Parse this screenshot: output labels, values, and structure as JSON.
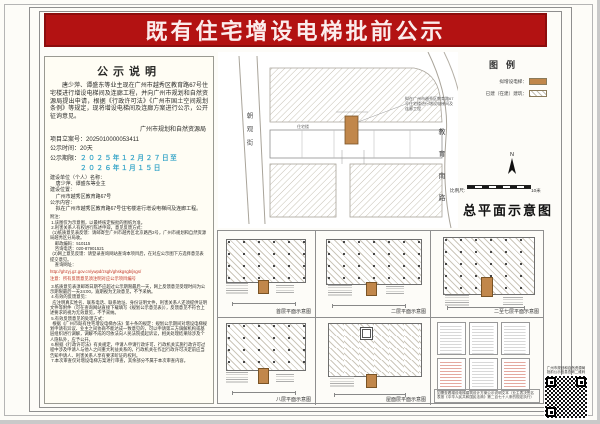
{
  "banner": {
    "title": "既有住宅增设电梯批前公示"
  },
  "notice": {
    "heading": "公示说明",
    "paragraph": "唐少萍、谭盛东等业主现在广州市越秀区教育路67号住宅楼进行增设电梯间及连廊工程，并向广州市规划和自然资源局提出申请，根据《行政许可法》《广州市国土空间规划条例》等规定，现将增设电梯间及连廊方案进行公示，公开征询意见。",
    "signature": "广州市规划和自然资源局",
    "case_no_label": "项目立案号：",
    "case_no": "2025010000053411",
    "duration_label": "公示时间：",
    "duration": "20天",
    "period_label": "公示期限：",
    "period_line1": "２０２５年１２月２７日至",
    "period_line2": "２０２６年１月１５日",
    "info_text": "建设单位（个人）名称：\n    唐少萍、谭盛东等业主\n建设位置：\n    广州市越秀区教育路67号\n公示内容：\n    拟在广州市越秀区教育路67号住宅楼进行增设电梯间及连廊工程。",
    "notes_part1": "附注：\n 1.该图仅为示意图，以最终核定报批的图纸为准。\n 2.利害关系人有权进行陈述申辩，意见反馈方式：\n  (1)纸质意见表反馈：请邮寄至广州市越秀区北京路西2号，广州市规划和自然资源局越秀区分局收。\n    邮政编码：510115\n    咨询电话：020-87901521\n  (2)网上意见反馈：请登录查询网站查询本项目后，在对应公示图下方选择意见表提交意见。\n    查询网址：",
    "notes_url": "http://ghzyj.gz.gov.cn/ywpd/zsgh/ghskgsgb/jsgs/",
    "notes_warning": "注意：所有反馈意见须注明对应公示项目编号",
    "notes_part2": " 3.纸质意见表须邮寄日期不应超过公示期限最后一天，网上反馈意见受理时间为公示期限最后一天24:00，逾期视为无效意见，不予采纳。\n 4.有效的反馈意见：\n  应注明真实姓名、联系电话、联系地址、身份证明文件，利害关系人还须提供证明文件等附件（可在查询网站直接下载填写《规划公示意见表》），反馈意见不符合上述要求的视为无效意见，不予采纳。\n 5.有效反馈意见的处理方式：\n  根据《广州市既有住宅增设电梯办法》第十条的规定：规划公示期间对增设电梯规划申请有异议、业主之间协商不能达成一致意见的，可以申请第三方调解机构或基层组织进行调解，调解不成的可依法向人民法院提起诉讼，相关处理结果除涉及个人隐私外，应予公开。\n 6.根据《行政许可法》有关规定，申请人申请行政许可、行政机关实施行政许可过程中涉及申请人与他人之间重大利益关系的，行政机关在作出行政许可决定前应当告知申请人、利害关系人享有要求听证的权利。\n 7.本次审查仅对增设电梯方案进行审查，其余部分不属于本次审查内容。"
  },
  "siteplan": {
    "street_left": "朝观街",
    "street_right": "教育南路",
    "building_label": "住宅楼",
    "annotation": "拟在广州市越秀区教育路67号住宅楼进行增设电梯间及连廊工程",
    "caption": "总平面示意图",
    "north_label": "N",
    "scale_label": "比例尺:",
    "scale_ticks": [
      "0",
      "1",
      "3",
      "5"
    ],
    "scale_end": "10米"
  },
  "legend": {
    "title": "图例",
    "items": [
      {
        "label": "拟增设电梯：",
        "swatch": "elevator-brown"
      },
      {
        "label": "已建（在建）建筑：",
        "swatch": "hatched"
      }
    ]
  },
  "plans": {
    "row1": [
      "首层平面示意图",
      "二层平面示意图",
      "二至七层平面示意图"
    ],
    "row2": [
      "八层平面示意图",
      "屋面层平面示意图"
    ],
    "docs_caption": "如需查看增设电梯建筑设计方案公示说明文本（业主表决签名表按《中华人民共和国民法典》第二百七十八条的规定执行）"
  },
  "qr": {
    "caption_line1": "广州市规划和自然资源局",
    "caption_line2": "批前公示信息查询二维码"
  },
  "colors": {
    "banner_red": "#b31212",
    "elevator_brown": "#c1874b",
    "period_teal": "#39a6c9",
    "link_red": "#c23526"
  }
}
